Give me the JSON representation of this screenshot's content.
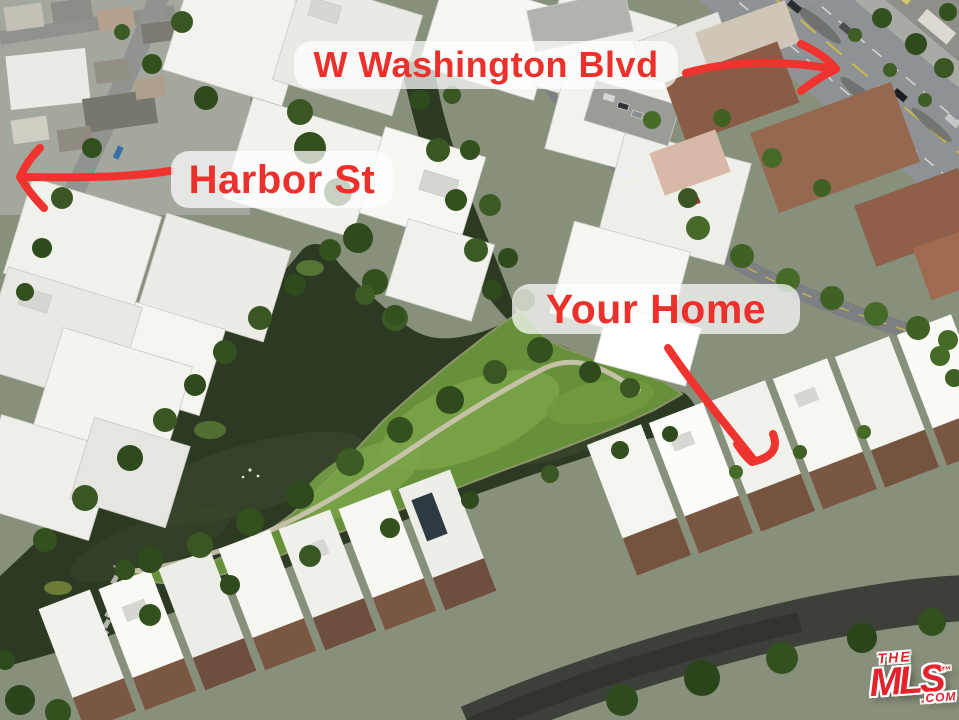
{
  "annotations": {
    "washington_blvd": {
      "label": "W Washington Blvd"
    },
    "harbor_st": {
      "label": "Harbor St"
    },
    "your_home": {
      "label": "Your Home"
    }
  },
  "watermark": {
    "line1": "THE",
    "line2": "MLS",
    "tm": "™",
    "suffix": ".COM"
  },
  "colors": {
    "annotation_red": "#EC302C",
    "label_background": "rgba(255,255,255,0.72)",
    "logo_red": "#E3242B",
    "water_green": "#2C3A24",
    "park_green": "#66903A",
    "roof_white": "#F3F3ED",
    "road_dark": "#3C4038"
  }
}
